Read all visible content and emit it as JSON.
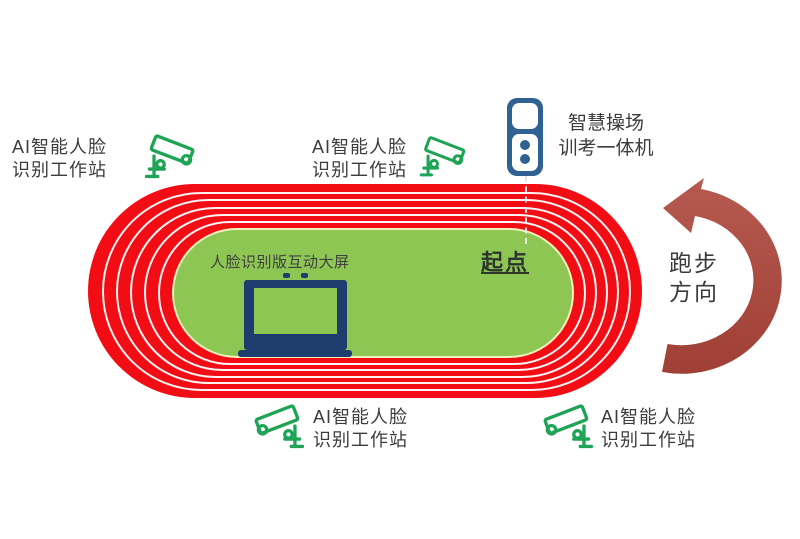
{
  "stations": [
    {
      "position": "top-left",
      "line1": "AI智能人脸",
      "line2": "识别工作站"
    },
    {
      "position": "top-middle",
      "line1": "AI智能人脸",
      "line2": "识别工作站"
    },
    {
      "position": "bottom-left",
      "line1": "AI智能人脸",
      "line2": "识别工作站"
    },
    {
      "position": "bottom-right",
      "line1": "AI智能人脸",
      "line2": "识别工作站"
    }
  ],
  "kiosk": {
    "line1": "智慧操场",
    "line2": "训考一体机"
  },
  "infield": {
    "screen_label": "人脸识别版互动大屏"
  },
  "track": {
    "start_label": "起点",
    "lanes": 6
  },
  "direction": {
    "line1": "跑步",
    "line2": "方向"
  },
  "icons": {
    "camera": "cctv-camera-icon",
    "kiosk": "kiosk-device-icon",
    "laptop": "laptop-icon",
    "arrow": "run-direction-arrow-icon"
  },
  "colors": {
    "track_red": "#f20d15",
    "lane_line_white": "#ffffff",
    "infield_green": "#8dc653",
    "camera_green": "#1fa456",
    "kiosk_blue": "#2f6293",
    "laptop_navy": "#1d3d6e",
    "arrow_red": "#ae4a40",
    "text": "#3c3c3c"
  }
}
